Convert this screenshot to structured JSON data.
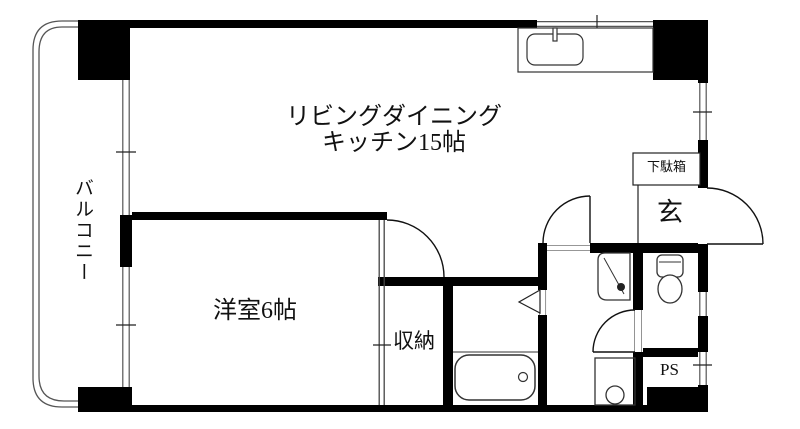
{
  "labels": {
    "ldk_line1": "リビングダイニング",
    "ldk_line2": "キッチン15帖",
    "western_room": "洋室6帖",
    "closet": "収納",
    "balcony": "バルコニー",
    "shoe_cabinet": "下駄箱",
    "entrance": "玄",
    "pipe_space": "PS"
  },
  "colors": {
    "wall": "#000000",
    "background": "#ffffff",
    "window_line": "#555555",
    "fixture_line": "#333333"
  }
}
